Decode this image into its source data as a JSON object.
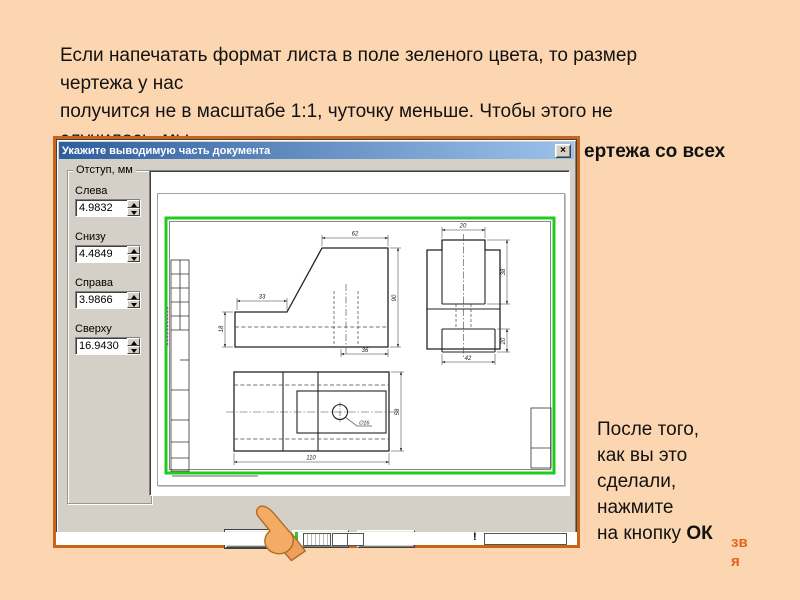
{
  "slide": {
    "top_lines": [
      "Если напечатать формат листа в поле зеленого цвета, то размер",
      "чертежа у нас",
      "получится не в масштабе 1:1,  чуточку меньше. Чтобы этого не",
      "случилось, мы"
    ],
    "overlap_fragment": "ертежа со всех",
    "note_lines": [
      "После того,",
      "как вы это",
      "сделали,",
      "нажмите"
    ],
    "note_last": {
      "prefix": "на кнопку ",
      "bold": "ОК"
    },
    "watermark": {
      "line1": "зв",
      "line2": "я"
    },
    "colors": {
      "background": "#fcd6b0",
      "frame": "#c8651b",
      "watermark": "#e2631c",
      "green_frame": "#1ecb1e"
    }
  },
  "dialog": {
    "title": "Укажите выводимую часть документа",
    "close_glyph": "×",
    "group_title": "Отступ, мм",
    "fields": [
      {
        "label": "Слева",
        "value": "4.9832"
      },
      {
        "label": "Снизу",
        "value": "4.4849"
      },
      {
        "label": "Справа",
        "value": "3.9866"
      },
      {
        "label": "Сверху",
        "value": "16.9430"
      }
    ],
    "buttons": {
      "ok": "ОК",
      "cancel": "Отмена",
      "help_underline": "С",
      "help_rest": "правка"
    },
    "artifact_mark": "!"
  },
  "drawing": {
    "dims": {
      "front_width": "62",
      "front_step": "33",
      "front_bottom": "36",
      "front_left": "18",
      "front_height": "90",
      "side_top": "20",
      "side_tab": "38",
      "side_notch": "20",
      "side_bottom": "42",
      "plan_width": "110",
      "plan_height": "58",
      "hole": "∅16"
    }
  }
}
